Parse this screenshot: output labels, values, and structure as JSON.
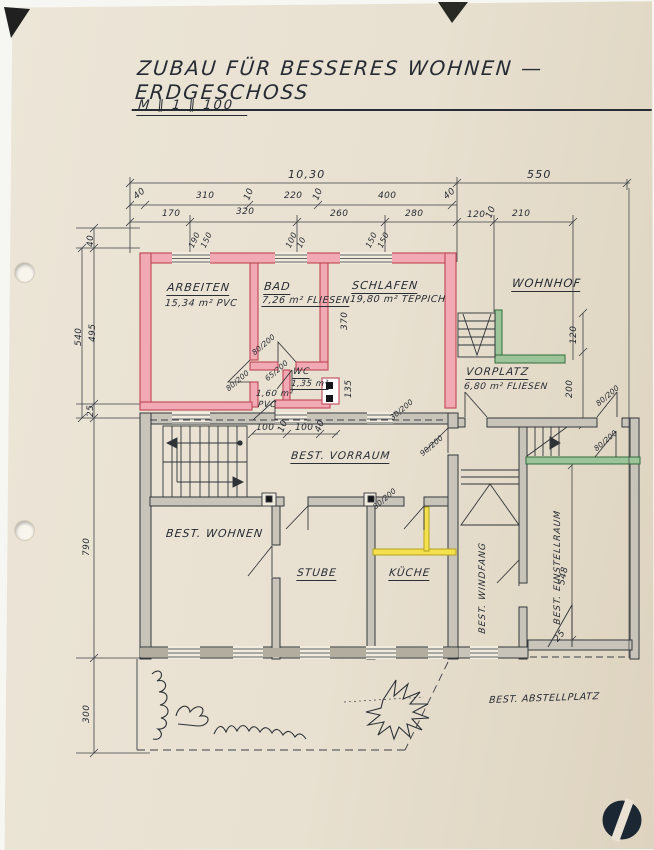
{
  "page": {
    "title": "ZUBAU FÜR BESSERES WOHNEN — ERDGESCHOSS",
    "scale": "M ∥ 1 ∥ 100"
  },
  "colors": {
    "paper": "#eae3d4",
    "ink": "#2d3138",
    "wall_new_red": "#f1a9b3",
    "wall_new_red_edge": "#bf4655",
    "wall_existing_grey": "#c9c4ba",
    "wall_green": "#9cc39a",
    "wall_yellow": "#f4e14d",
    "logo_navy": "#1c2734"
  },
  "rooms": {
    "arbeiten": {
      "name": "ARBEITEN",
      "area": "15,34 m²  PVC"
    },
    "bad": {
      "name": "BAD",
      "area": "7,26 m²  FLIESEN"
    },
    "schlafen": {
      "name": "SCHLAFEN",
      "area": "19,80 m²  TEPPICH"
    },
    "wc": {
      "name": "WC",
      "area": "1,35 m²"
    },
    "flur": {
      "area": "1,60 m²",
      "floor": "PVC"
    },
    "wohnhof": {
      "name": "WOHNHOF"
    },
    "vorplatz": {
      "name": "VORPLATZ",
      "area": "6,80 m²  FLIESEN"
    },
    "vorraum": {
      "name": "BEST. VORRAUM"
    },
    "wohnen": {
      "name": "BEST. WOHNEN"
    },
    "stube": {
      "name": "STUBE"
    },
    "kueche": {
      "name": "KÜCHE"
    },
    "windfang": {
      "name": "BEST. WINDFANG"
    },
    "einstellraum": {
      "name": "BEST. EINSTELLRAUM"
    },
    "abstellplatz": {
      "name": "BEST. ABSTELLPLATZ"
    }
  },
  "dims": {
    "total_width": "10,30",
    "right_width": "550",
    "row2": [
      "40",
      "310",
      "10",
      "220",
      "10",
      "400",
      "40"
    ],
    "row3": [
      "170",
      "320",
      "260",
      "280",
      "120",
      "10",
      "210"
    ],
    "windows_top": [
      "190",
      "150",
      "100",
      "10",
      "150",
      "150"
    ],
    "left": [
      "40",
      "540",
      "495",
      "25",
      "790",
      "300"
    ],
    "right": [
      "120",
      "200"
    ],
    "schlafen_depth": "370",
    "wc_depth": "135",
    "einstellraum_depth": "548",
    "bottom_right": "25",
    "vorraum_row": [
      "100",
      "10",
      "100",
      "40"
    ],
    "doors": [
      "80/200",
      "65/200",
      "80/200",
      "30/200",
      "90/200",
      "80/200",
      "80/200",
      "80/200"
    ]
  }
}
